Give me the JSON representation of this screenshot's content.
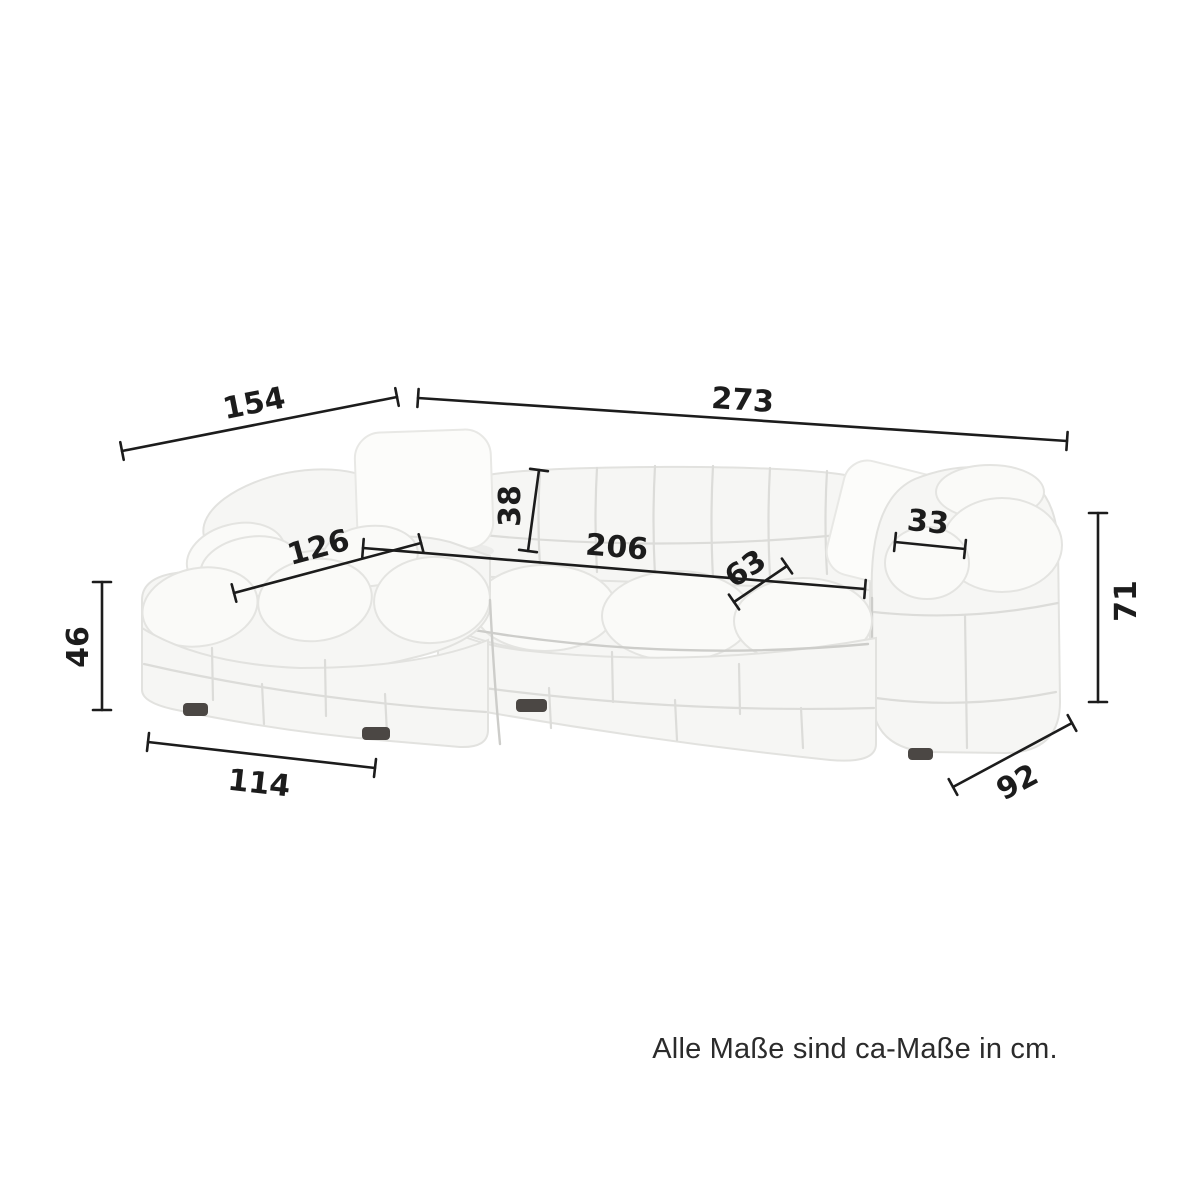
{
  "caption": "Alle Maße sind ca-Maße in cm.",
  "dimensions": [
    {
      "id": "total-depth-left",
      "value": "154"
    },
    {
      "id": "total-width",
      "value": "273"
    },
    {
      "id": "backrest-height",
      "value": "38"
    },
    {
      "id": "armrest-width",
      "value": "33"
    },
    {
      "id": "chaise-seat-length",
      "value": "126"
    },
    {
      "id": "seat-width",
      "value": "206"
    },
    {
      "id": "seat-depth",
      "value": "63"
    },
    {
      "id": "total-height",
      "value": "71"
    },
    {
      "id": "seat-height",
      "value": "46"
    },
    {
      "id": "chaise-front-width",
      "value": "114"
    },
    {
      "id": "body-depth",
      "value": "92"
    }
  ],
  "colors": {
    "background": "#ffffff",
    "dimension_line": "#1c1c1c",
    "dimension_text": "#1c1c1c",
    "caption_text": "#2b2b2b",
    "sofa_body": "#f6f6f4",
    "sofa_seam": "#dcdcd9",
    "sofa_foot": "#4b4744"
  }
}
